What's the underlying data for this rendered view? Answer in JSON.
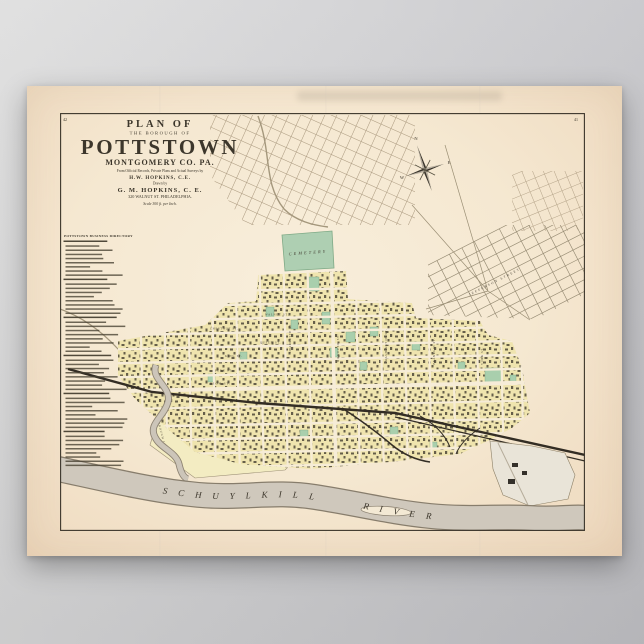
{
  "poster": {
    "page_numbers": {
      "left": "42",
      "right": "41"
    },
    "title": {
      "plan_of": "PLAN OF",
      "borough_of": "THE BOROUGH OF",
      "name": "POTTSTOWN",
      "county": "MONTGOMERY CO. PA.",
      "records": "From Official Records, Private Plans and Actual Surveys by",
      "surveyor": "H.W. HOPKINS, C.E.",
      "drawn_by": "Drawn by",
      "drafter": "G. M. HOPKINS, C. E.",
      "address": "320 WALNUT ST. PHILADELPHIA.",
      "scale": "Scale 300 ft. per Inch."
    },
    "directory": {
      "header": "POTTSTOWN BUSINESS DIRECTORY"
    },
    "compass": {
      "n": "N",
      "e": "E",
      "w": "W"
    },
    "map_labels": {
      "cemetery": "CEMETERY",
      "river": "SCHUYLKILL RIVER",
      "borough_line": "BOROUGH LINE",
      "estate": "TYLER Co.",
      "streets": [
        "HIGH ST.",
        "HANOVER ST.",
        "KING ST.",
        "QUEEN ST.",
        "CHESTNUT ST.",
        "WALNUT ST.",
        "CHARLOTTE ST.",
        "WASHINGTON ST.",
        "FRANKLIN ST.",
        "YORK ST.",
        "PENN ST.",
        "JEFFERSON STREET"
      ]
    },
    "colors": {
      "paper": "#f5e9d4",
      "town_yellow": "#efe4ae",
      "green": "#aecfb2",
      "river_gray": "#cfc8bc",
      "rail_dark": "#332d24",
      "ink": "#3c362b",
      "wall": "#cfcfd2"
    }
  }
}
